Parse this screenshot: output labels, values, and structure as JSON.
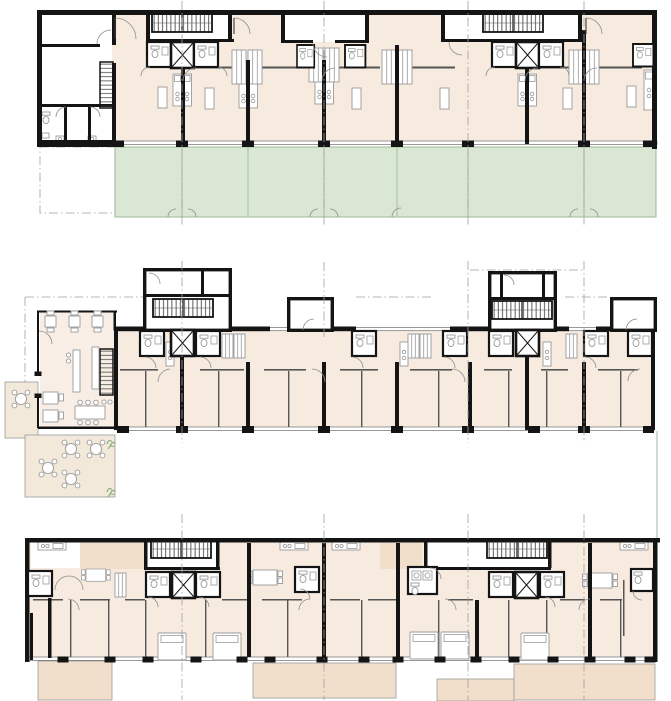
{
  "sheet": {
    "type": "architectural floor plan sheet",
    "floors": [
      {
        "id": "plan-top",
        "label": "floor plan with four dwelling units, two stair-elevator cores, service wing left and private garden terraces"
      },
      {
        "id": "plan-middle",
        "label": "floor plan with cafe wing, outdoor terrace with round tables, two stair towers, two loggia boxes and room band"
      },
      {
        "id": "plan-bottom",
        "label": "floor plan with apartments, two stair-elevator cores, bedrooms with beds and four balconies"
      }
    ],
    "elements": {
      "staircase": "hatched tread run",
      "elevator": "shaft with X symbol",
      "bathroom": "pod with WC and sink",
      "kitchen": "counter with burner circles",
      "garden_terrace_count": 7,
      "balcony_count": 4,
      "outdoor_round_tables": 5,
      "beds": 5
    }
  },
  "colors": {
    "paper": "#ffffff",
    "wall": "#141414",
    "room_fill": "#f7ebe0",
    "room_fill_light": "#f8eee5",
    "terrace_fill": "#f2e9db",
    "balcony_fill": "#f1dfcc",
    "garden_fill": "#dae7d4",
    "garden_edge": "#9fb896",
    "thin_line": "#6e6e6e",
    "furniture_line": "#9a9a9a",
    "grid_line": "#a0a0a0",
    "plant_green": "#7fa874"
  }
}
